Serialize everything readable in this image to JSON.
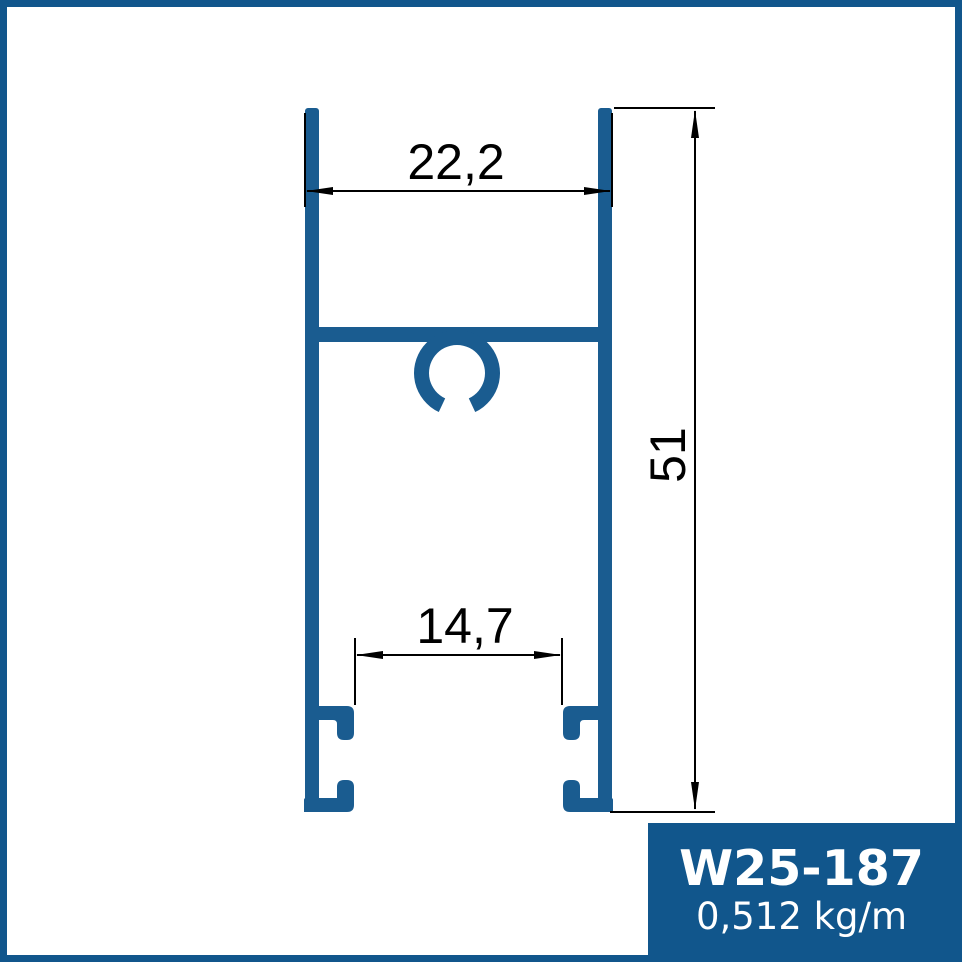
{
  "drawing": {
    "dim_top_width": "22,2",
    "dim_bottom_inner_width": "14,7",
    "dim_height": "51"
  },
  "label_box": {
    "profile_code": "W25-187",
    "unit_weight": "0,512 kg/m"
  },
  "colors": {
    "border-blue": "#11568C",
    "box-blue": "#11568C",
    "profile-blue": "#1A5C90",
    "dim-black": "#000000"
  }
}
